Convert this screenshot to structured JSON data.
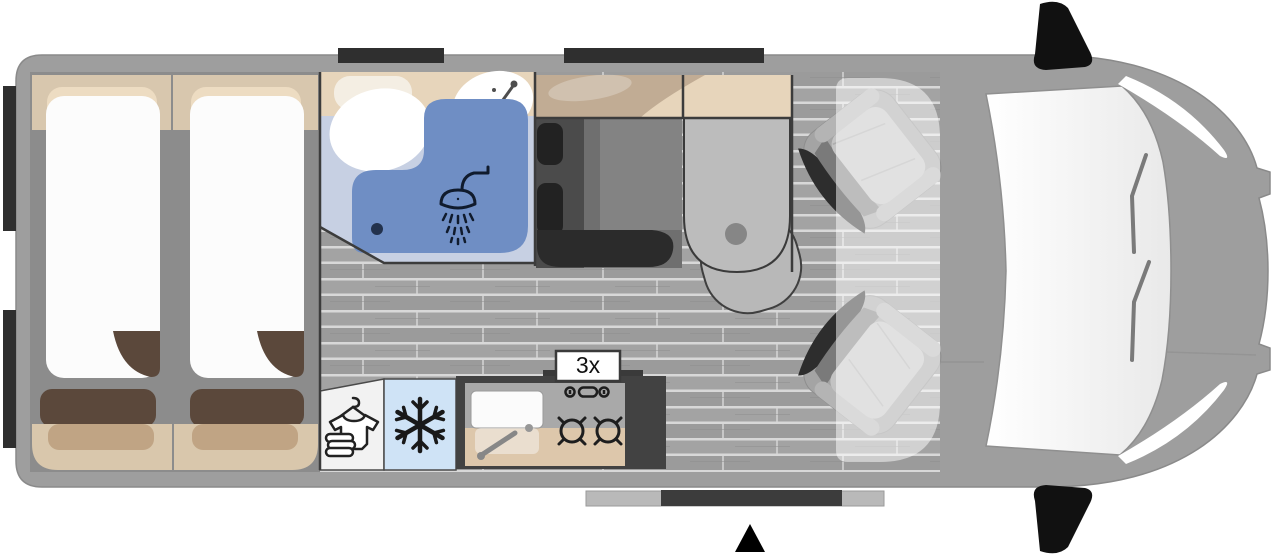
{
  "floorplan": {
    "vehicle": "campervan",
    "view": "top-down floor plan",
    "labels": {
      "burner_count": "3x"
    },
    "rooms": [
      "twin-single-beds",
      "bathroom-with-shower",
      "wardrobe",
      "fridge",
      "kitchen-block",
      "dinette-bench",
      "pedestal-table",
      "swivel-cab-seats",
      "driver-cab"
    ],
    "icons": [
      "shower-head-icon",
      "faucet-icon",
      "drain-icon",
      "snowflake-icon",
      "clothes-wardrobe-icon",
      "stove-knobs-icon",
      "gas-burner-icon",
      "entrance-arrow-icon",
      "side-mirror-icon",
      "window-bar-icon",
      "sliding-door-icon"
    ],
    "colors": {
      "body_gray": "#9e9e9e",
      "bed_area_gray": "#8c8c8c",
      "mattress_white": "#fcfcfc",
      "headboard_beige": "#d8c7ae",
      "pillow_beige": "#eddcc2",
      "cushion_brown": "#5b483b",
      "bench_beige": "#d9c7ac",
      "bench_shadow": "#c0a484",
      "bathroom_blue": "#c7d0e3",
      "shower_blue": "#6f8ec4",
      "counter_beige": "#e7d5bb",
      "seat_charcoal": "#4b4b4b",
      "table_gray": "#bcbcbc",
      "fridge_blue": "#cfe3f6",
      "wardrobe_white": "#f2f2f2",
      "kitchen_frame": "#424242",
      "windshield_white": "#f5f5f5",
      "accent_black": "#1d1d1d"
    }
  }
}
